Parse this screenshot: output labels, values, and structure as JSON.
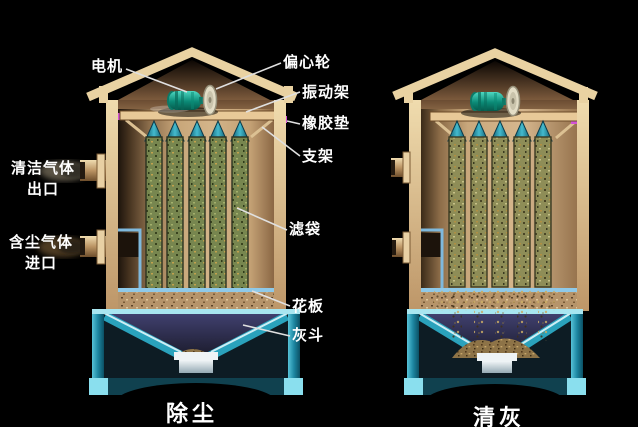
{
  "labels": {
    "motor": "电机",
    "eccentric_wheel": "偏心轮",
    "vibration_frame": "振动架",
    "rubber_pad": "橡胶垫",
    "support_frame": "支架",
    "clean_gas_outlet_line1": "清洁气体",
    "clean_gas_outlet_line2": "出口",
    "dusty_gas_inlet_line1": "含尘气体",
    "dusty_gas_inlet_line2": "进口",
    "filter_bag": "滤袋",
    "tube_sheet": "花板",
    "ash_hopper": "灰斗"
  },
  "captions": {
    "left_mode": "除尘",
    "right_mode": "清灰"
  },
  "colors": {
    "background": "#000000",
    "shell_tan": "#e8d0a4",
    "hopper_cyan": "#2596b2",
    "bag_olive": "#77864f",
    "cone_teal": "#1f8ba4",
    "motor_teal": "#12a08c",
    "rubber_pad_magenta": "#d352d6",
    "duct_blue": "#7fb9dd",
    "label_text": "#ffffff",
    "leader_line": "#e0e0e0"
  }
}
